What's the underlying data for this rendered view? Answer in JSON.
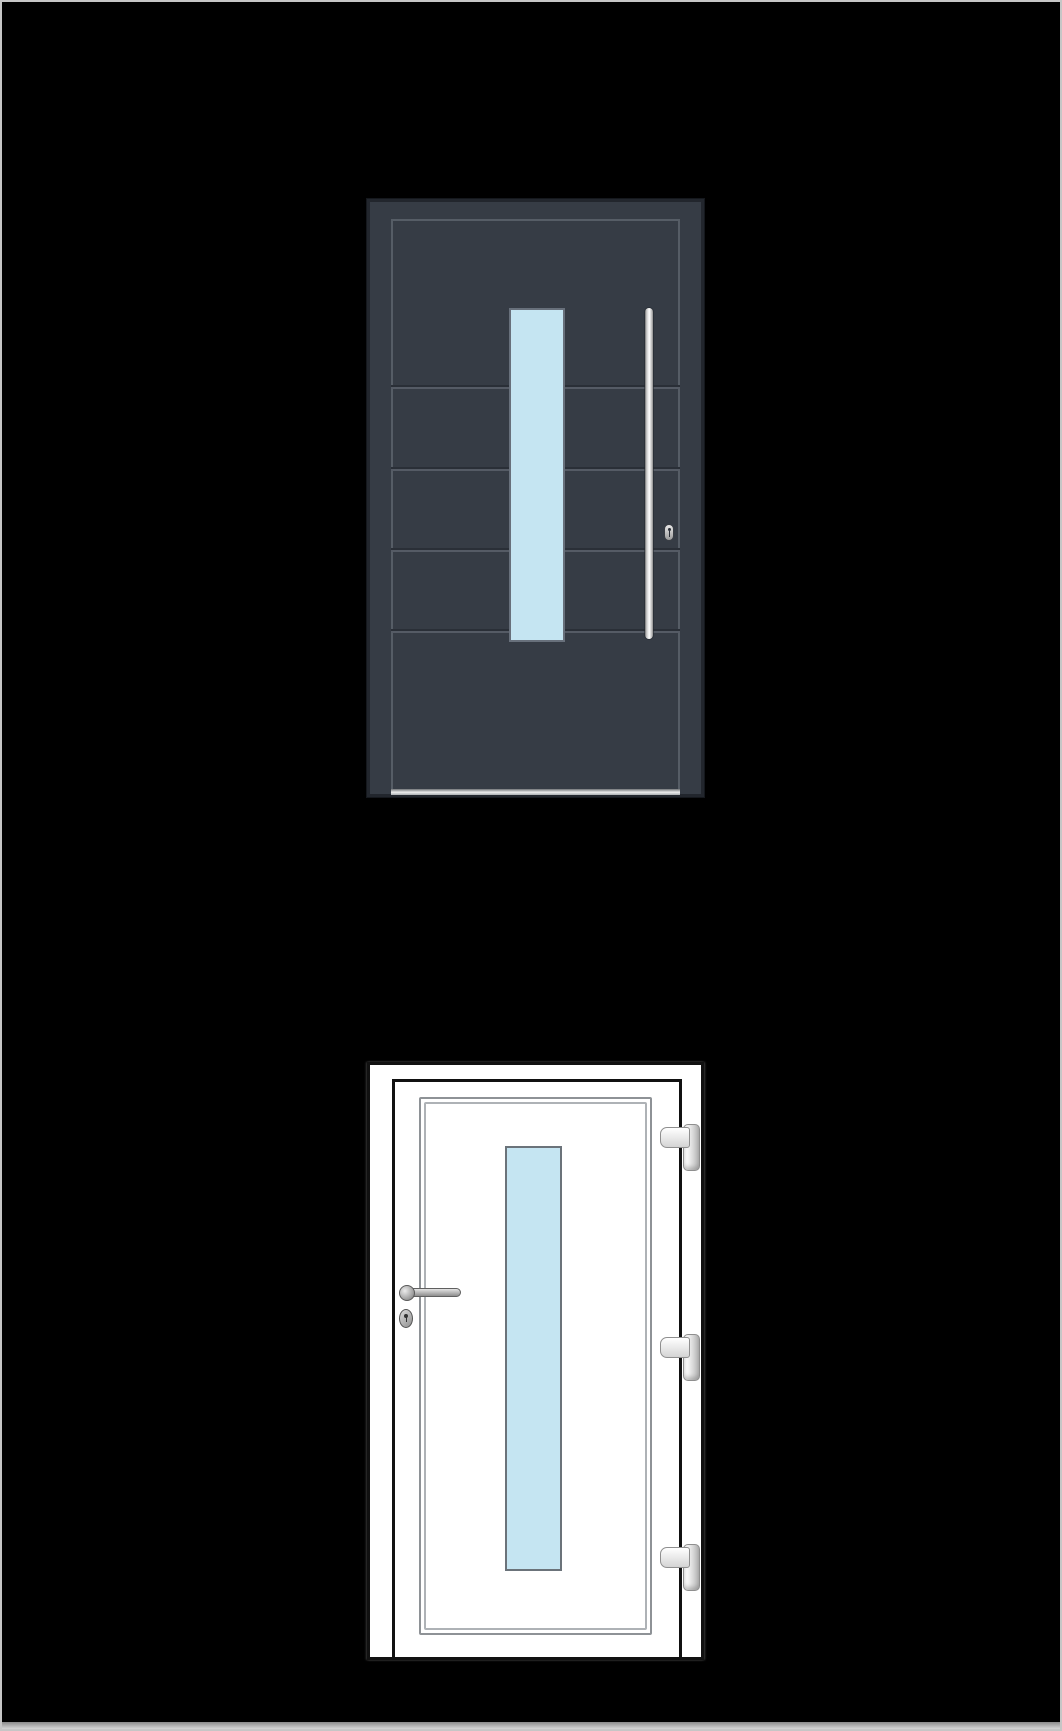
{
  "scene": {
    "description": "Two entrance-door product illustrations on a black background",
    "text_content": "none"
  },
  "doors": [
    {
      "id": "anthracite-entrance-door",
      "view": "closed front view",
      "groove_count": 4,
      "parts": [
        "door-slab",
        "inner-frame-line",
        "horizontal-grooves",
        "vertical-glass-panel",
        "vertical-bar-handle",
        "lock-cylinder",
        "threshold-sill"
      ]
    },
    {
      "id": "white-entrance-door",
      "view": "door leaf inside frame",
      "hinge_count": 3,
      "parts": [
        "door-frame",
        "door-leaf",
        "double-trim-lines",
        "vertical-glass-panel",
        "lever-handle",
        "handle-rose",
        "oval-lock-escutcheon",
        "hinges-right-side"
      ]
    }
  ],
  "colors": {
    "bg": "#000000",
    "page-border": "#c6c6c6",
    "bar-top": "#8a8a8a",
    "bar-bottom": "#d6d6d6",
    "d1-slab": "#363c45",
    "d1-edge": "#22262d",
    "d1-line": "#5c636c",
    "d1-groove-dark": "#2a2f37",
    "d1-groove-light": "#555b65",
    "d1-sill-dark": "#6f7276",
    "d1-sill-light": "#eceded",
    "d1-glass-border": "#68707b",
    "glass-blue": "#c5e5f2",
    "metal-dark": "#8a8a8a",
    "metal-light": "#ffffff",
    "d2-border": "#111111",
    "d2-white": "#ffffff",
    "d2-trim-outer": "#8e9296",
    "d2-trim-inner": "#aeb2b6",
    "d2-glass-border": "#6b737a"
  }
}
